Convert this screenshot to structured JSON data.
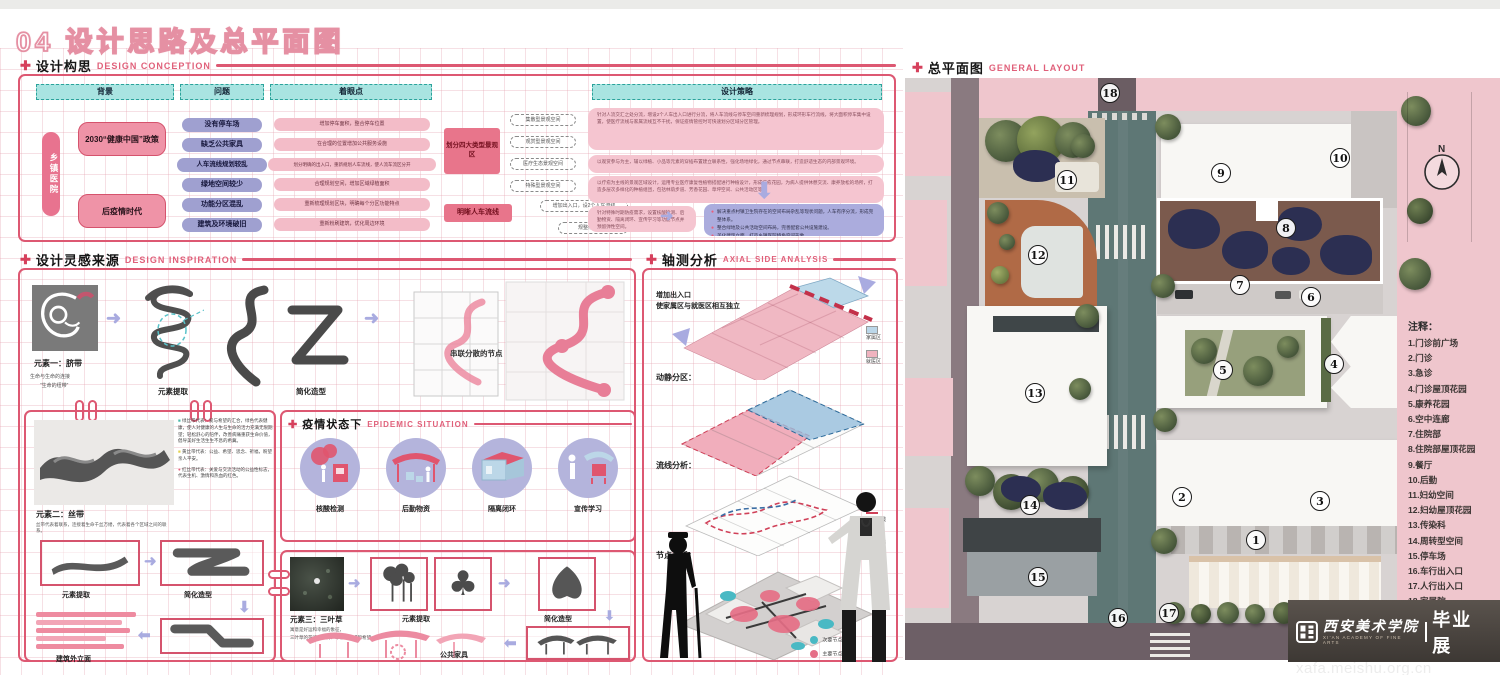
{
  "title": "04 设计思路及总平面图",
  "conception": {
    "title_zh": "设计构思",
    "title_en": "DESIGN CONCEPTION",
    "columns": [
      "背景",
      "问题",
      "着眼点",
      "设计策略"
    ],
    "side_label": "乡镇医院",
    "background_items": [
      "2030“健康中国”政策",
      "后疫情时代"
    ],
    "problems": [
      "没有停车场",
      "缺乏公共家具",
      "人车流线规划较乱",
      "绿地空间较少",
      "功能分区混乱",
      "建筑及环境破旧"
    ],
    "focus_points": [
      "增加停车面积，整合停车位置",
      "在合理的位置增加公共服务设施",
      "划分明确的出入口，重新规划人车流线，使人流车流区分开",
      "合理规划空间，增加区域绿植面积",
      "重新梳理规划区块，明确每个分区功能特点",
      "重新粉刷建筑，优化周边环境"
    ],
    "strategy_group1": "划分四大类型景观区",
    "strategy_group1_items": [
      "集散型景观空间",
      "观赏型景观空间",
      "医疗生态景观空间",
      "特殊型景观空间"
    ],
    "strategy_group2": "明晰人车流线",
    "strategy_group2_items": [
      "增加出入口，设2个人车流线",
      "规整停车空间"
    ],
    "strategies": [
      "针对人流交汇之处分流，增设2个人车出入口进行分流，将人车流线与停车空间重新梳理规划，形成环形车行流线，将大面积停车集中设置，使医疗流线与家属流线互不干扰，保证疫情管控时可快速划分区域分区管理。",
      "以观赏参与为主，辅以绿植、小品等元素的穿插布置建立联系性，强化场地绿化，通过节点串联，打造舒适生态的内部景观环境。",
      "以疗愈为主线的景观区域设计，运用专业医疗康复性植物搭配进行种植设计，形成疗愈花园，为病人提供休憩交流、康养放松的场所，打造多层次多样化的种植组团，包括林荫步道、芳香花园、草坪空间、公共活动区等。",
      "针对特殊时期防疫需求，设置核酸检测、后勤物资、隔离闭环、宣传学习等功能节点并预留弹性空间。"
    ],
    "summary_points": [
      "解决重点村镇卫生院存在的空间布局杂乱等现状问题，人车有序分流，形成完整体系。",
      "整合绿地及公共活动空间布局，完善配套公共设施建设。",
      "美化建筑立面，打造乡镇医院特色空间形象。"
    ]
  },
  "inspiration": {
    "title_zh": "设计灵感来源",
    "title_en": "DESIGN INSPIRATION",
    "element1": {
      "name": "元素一：脐带",
      "caption1": "生命与生命的连接",
      "caption2": "“生命的纽带”",
      "step1": "元素提取",
      "step2": "简化造型",
      "step3": "串联分散的节点"
    },
    "element2": {
      "name": "元素二：丝带",
      "caption": "丝带代表着联系，连接着生命千丝万缕，代表着各个区域之间的联系。",
      "ribbon_green": "绿丝带代表：爱与希望的汇合，绿色代表健康，使人对健康的人生与生命的活力充满无限期望；轻松舒心的陪伴，改善病痛重获生命价值，倡导美好生活生生不息的希冀。",
      "ribbon_yellow": "黄丝带代表：公益、希望、思念、祈福，盼望亲人平安。",
      "ribbon_red": "红丝带代表：关爱与交流活动的公益性标志，代表生机、激情和热血的红色。",
      "step1": "元素提取",
      "step2": "简化造型",
      "step3": "建筑外立面"
    },
    "element3": {
      "name": "元素三：三叶草",
      "caption1": "寓意是好运和幸福的象征，",
      "caption2": "三叶草的花语是爱情、幸福、祈求和希望。",
      "step1": "元素提取",
      "step2": "简化造型",
      "step3": "公共家具"
    },
    "epidemic": {
      "title_zh": "疫情状态下",
      "title_en": "EPIDEMIC SITUATION",
      "items": [
        "核酸检测",
        "后勤物资",
        "隔离闭环",
        "宣传学习"
      ]
    }
  },
  "axial": {
    "title_zh": "轴测分析",
    "title_en": "AXIAL SIDE ANALYSIS",
    "note_line1": "增加出入口",
    "note_line2": "使家属区与就医区相互独立",
    "label_zoning": "动静分区：",
    "label_flow": "流线分析：",
    "label_nodes": "节点分析：",
    "legend_family": "家属区",
    "legend_medical": "就医区",
    "legend_pedestrian": "人行流线",
    "legend_vehicle": "车行流线",
    "legend_secondary": "次要节点",
    "legend_primary": "主要节点"
  },
  "layout": {
    "title_zh": "总平面图",
    "title_en": "GENERAL LAYOUT",
    "compass": "N",
    "legend_title": "注释：",
    "legend_items": [
      "1.门诊前广场",
      "2.门诊",
      "3.急诊",
      "4.门诊屋顶花园",
      "5.康养花园",
      "6.空中连廊",
      "7.住院部",
      "8.住院部屋顶花园",
      "9.餐厅",
      "10.后勤",
      "11.妇幼空间",
      "12.妇幼屋顶花园",
      "13.传染科",
      "14.周转型空间",
      "15.停车场",
      "16.车行出入口",
      "17.人行出入口",
      "18.家属院"
    ],
    "marker_labels": [
      "1",
      "2",
      "3",
      "4",
      "5",
      "6",
      "7",
      "8",
      "9",
      "10",
      "11",
      "12",
      "13",
      "14",
      "15",
      "16",
      "17",
      "18"
    ]
  },
  "footer": {
    "school_name": "西安美术学院",
    "school_sub": "XI'AN ACADEMY OF FINE ARTS",
    "exhibition": "毕业展",
    "url": "xafa.meishu.org.cn"
  }
}
